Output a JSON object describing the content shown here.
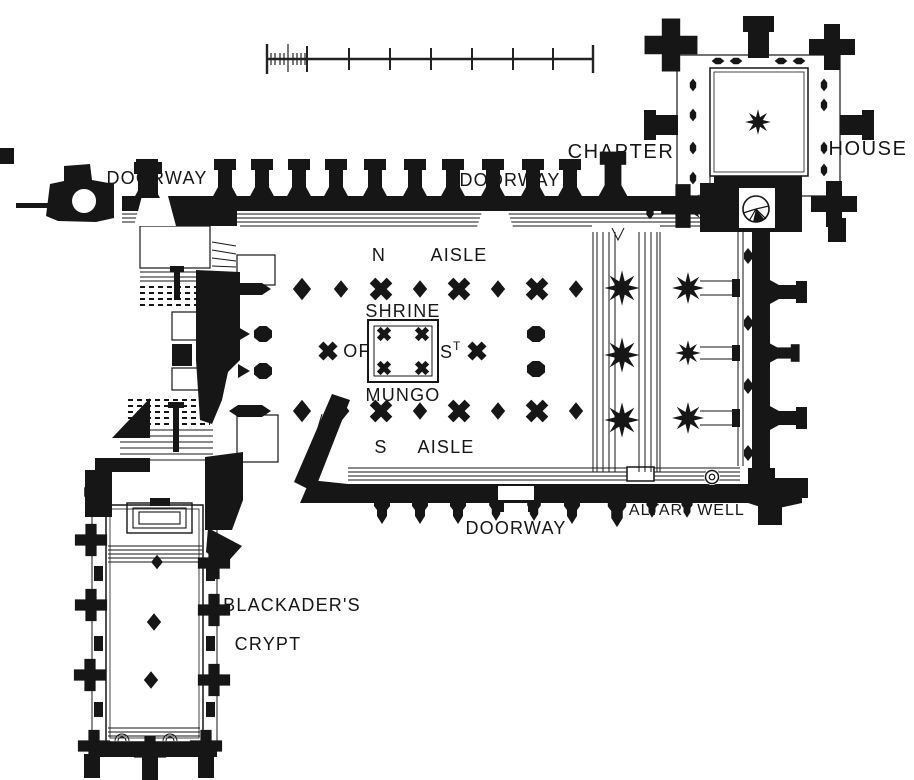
{
  "figure": {
    "kind": "architectural floor plan (engraved style, black ink on white)",
    "ink_color": "#161616",
    "paper_color": "#ffffff"
  },
  "labels": {
    "doorway_nw": "DOORWAY",
    "doorway_n": "DOORWAY",
    "doorway_s": "DOORWAY",
    "n_aisle_dir": "N",
    "n_aisle_word": "AISLE",
    "s_aisle_dir": "S",
    "s_aisle_word": "AISLE",
    "shrine": "SHRINE",
    "of": "OF",
    "st_s": "S",
    "st_t": "T",
    "mungo": "MUNGO",
    "altar": "ALTAR",
    "well": "WELL",
    "chapter": "CHAPTER",
    "house": "HOUSE",
    "blackaders": "BLACKADER'S",
    "crypt": "CRYPT"
  },
  "scale_bar": {
    "segments": 8,
    "first_segment_subdivided": true,
    "orientation": "horizontal"
  },
  "features": {
    "central_monument": "square shrine enclosure with four corner pier clusters",
    "stair_symbol": "circular spiral stair with radial treads",
    "pier_types": [
      "small diamond",
      "large notched diamond",
      "octagonal",
      "x-cluster",
      "eight-point star compound"
    ]
  }
}
